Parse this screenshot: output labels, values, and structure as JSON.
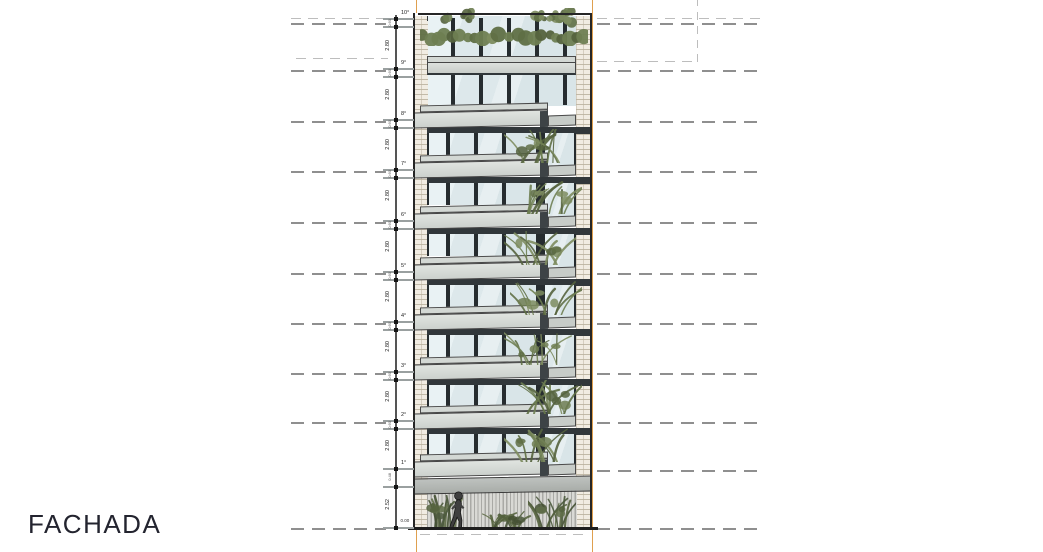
{
  "title": {
    "label": "FACHADA"
  },
  "elevation": {
    "levels": [
      {
        "label": "10°"
      },
      {
        "label": "9°"
      },
      {
        "label": "8°"
      },
      {
        "label": "7°"
      },
      {
        "label": "6°"
      },
      {
        "label": "5°"
      },
      {
        "label": "4°"
      },
      {
        "label": "3°"
      },
      {
        "label": "2°"
      },
      {
        "label": "1°"
      }
    ],
    "floor_dims": [
      "2.80",
      "2.80",
      "2.80",
      "2.80",
      "2.80",
      "2.80",
      "2.80",
      "2.80",
      "2.80"
    ],
    "ground_floor_dim": "2.52",
    "beam_dim": "0.48",
    "slab_tick_dim": "0.60",
    "datum_label": "0.00"
  },
  "icons": {
    "person": "walking-person-silhouette",
    "roof_plants": "roof-hedge",
    "balcony_plants": "balcony-plant",
    "ground_plants": "ground-shrubs"
  },
  "colors": {
    "guide_orange": "#DFA04F",
    "dash_gray": "#8F8F8F",
    "dark_band": "#31373A",
    "glass": "#E2ECEE",
    "slab_gray": "#D6DAD6",
    "plant_green": "#6B7A4E",
    "plant_dark": "#55633E",
    "outline": "#262626",
    "brick_joint": "#BAB19E",
    "louver_gray": "#A9A9A5"
  }
}
